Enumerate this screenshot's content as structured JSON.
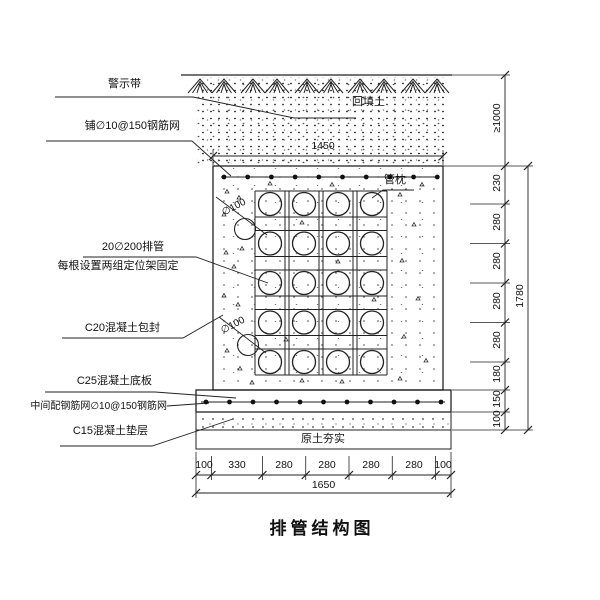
{
  "title": "排管结构图",
  "labels": {
    "warning_tape": "警示带",
    "top_mesh": "铺∅10@150钢筋网",
    "pipes_line1": "20∅200排管",
    "pipes_line2": "每根设置两组定位架固定",
    "encasement": "C20混凝土包封",
    "base_slab": "C25混凝土底板",
    "slab_mesh": "中间配钢筋网∅10@150钢筋网",
    "cushion": "C15混凝土垫层",
    "backfill": "回填土",
    "pipe_pillow": "管枕",
    "compacted_soil": "原土夯实",
    "pipe_dia_1": "∅100",
    "pipe_dia_2": "∅100"
  },
  "dimensions": {
    "top_width": "1450",
    "bottom_total": "1650",
    "bottom_segments": [
      "100",
      "330",
      "280",
      "280",
      "280",
      "280",
      "100"
    ],
    "right_cover": "≥1000",
    "right_segments": [
      "230",
      "280",
      "280",
      "280",
      "280",
      "180",
      "150",
      "100"
    ],
    "right_total": "1780"
  },
  "drawing": {
    "pipe_rows": 5,
    "pipe_cols": 4,
    "top_mesh_dots": 10,
    "slab_mesh_dots": 11
  }
}
